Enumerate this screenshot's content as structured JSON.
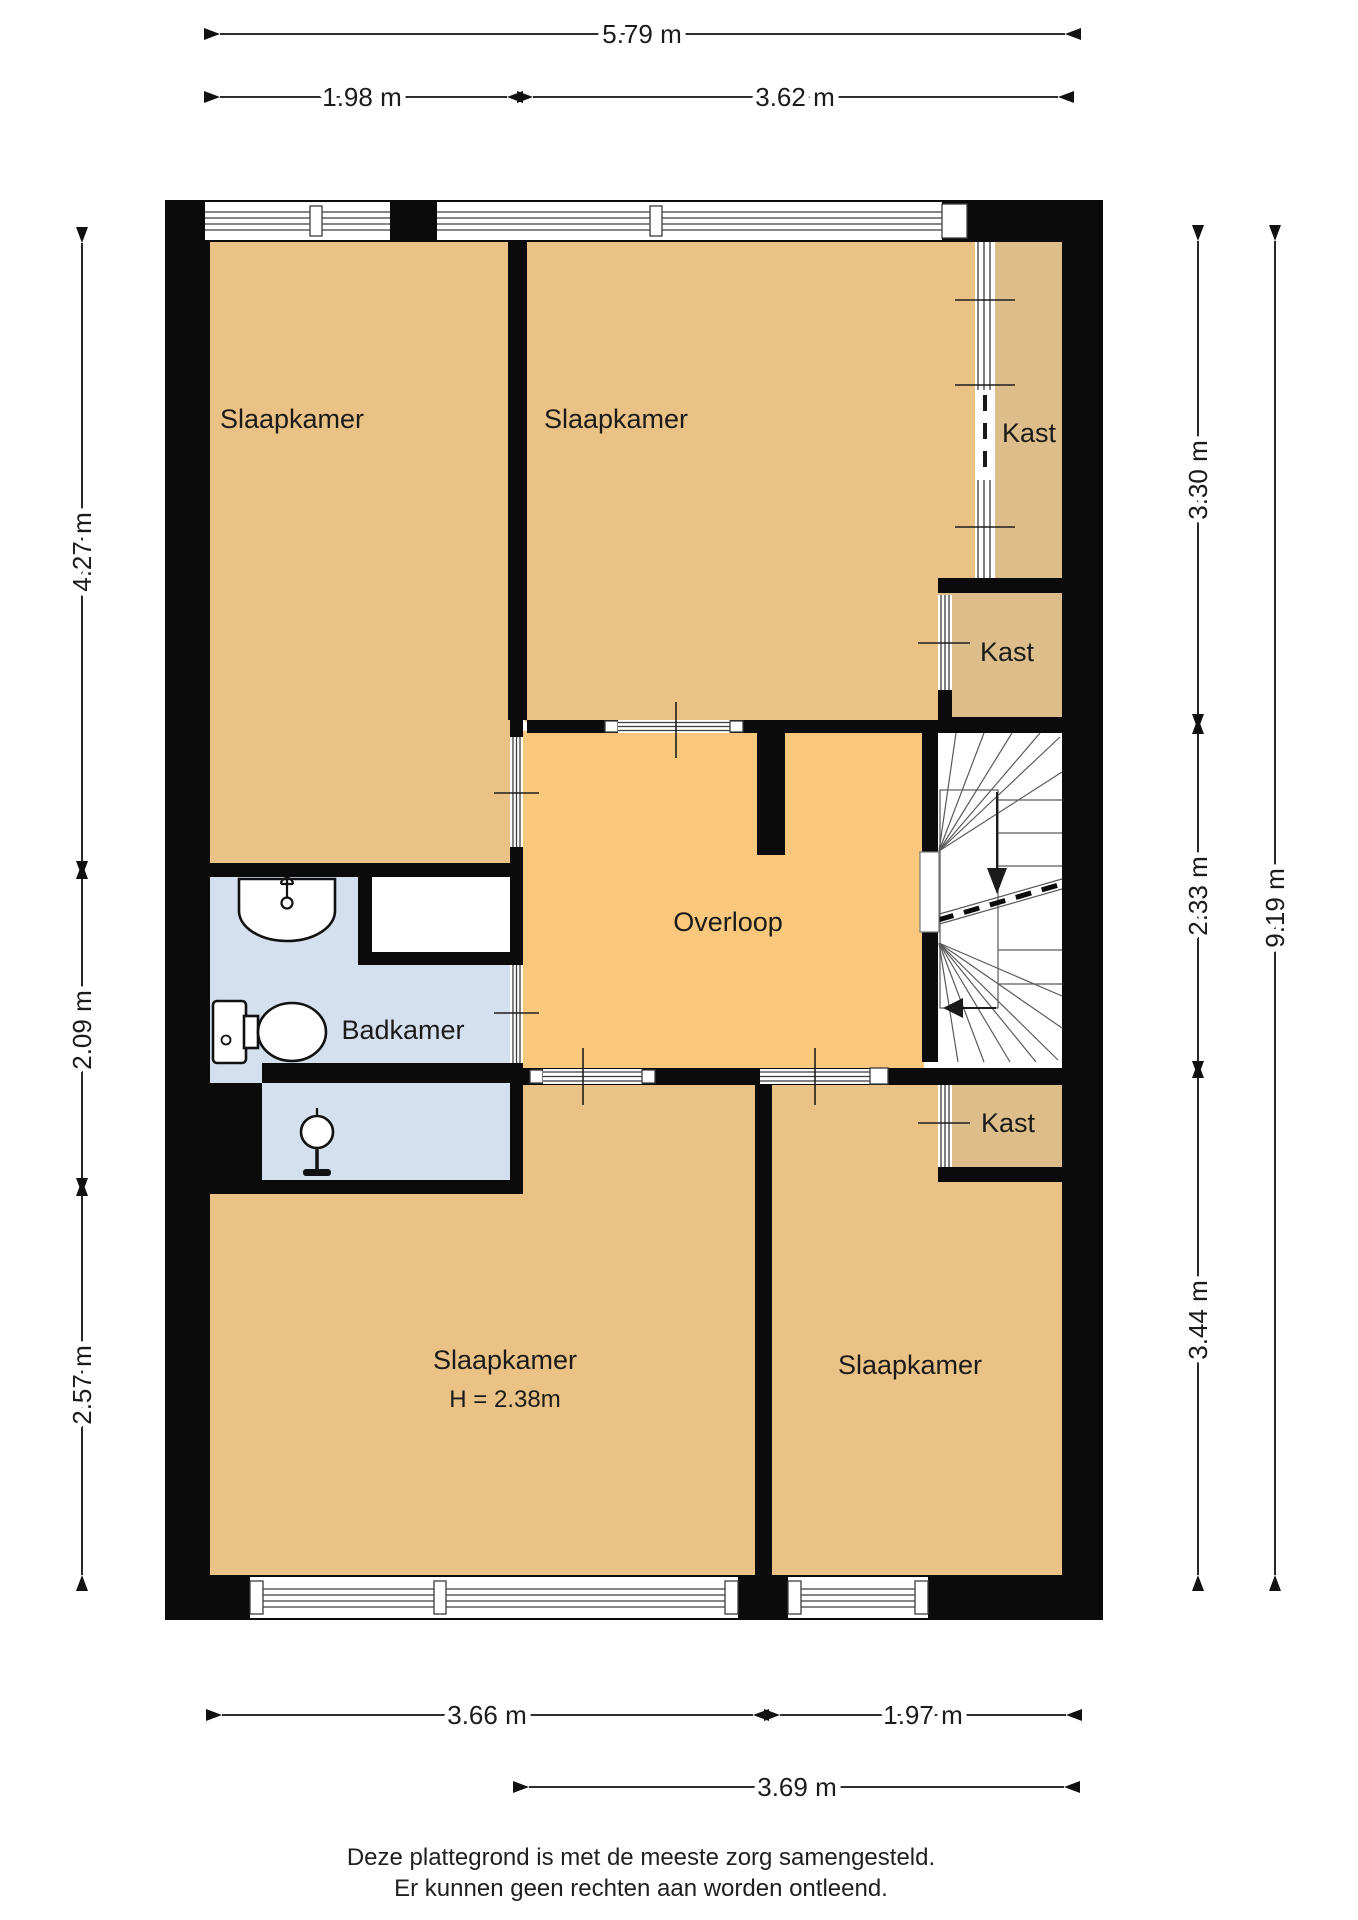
{
  "plan": {
    "rooms": [
      {
        "id": "slaapkamer-top-left",
        "label": "Slaapkamer"
      },
      {
        "id": "slaapkamer-top-middle",
        "label": "Slaapkamer"
      },
      {
        "id": "kast-top",
        "label": "Kast"
      },
      {
        "id": "kast-middle",
        "label": "Kast"
      },
      {
        "id": "overloop",
        "label": "Overloop"
      },
      {
        "id": "badkamer",
        "label": "Badkamer"
      },
      {
        "id": "slaapkamer-bottom-left",
        "label": "Slaapkamer",
        "height_note": "H = 2.38m"
      },
      {
        "id": "slaapkamer-bottom-right",
        "label": "Slaapkamer"
      },
      {
        "id": "kast-bottom",
        "label": "Kast"
      }
    ],
    "dimensions": {
      "top": [
        {
          "label": "5.79 m"
        },
        {
          "label": "1.98 m"
        },
        {
          "label": "3.62 m"
        }
      ],
      "left": [
        {
          "label": "4.27 m"
        },
        {
          "label": "2.09 m"
        },
        {
          "label": "2.57 m"
        }
      ],
      "right": [
        {
          "label": "3.30 m"
        },
        {
          "label": "2.33 m"
        },
        {
          "label": "3.44 m"
        },
        {
          "label": "9.19 m"
        }
      ],
      "bottom": [
        {
          "label": "3.66 m"
        },
        {
          "label": "1.97 m"
        },
        {
          "label": "3.69 m"
        }
      ]
    },
    "colors": {
      "room_fill": "#EBC286",
      "overloop_fill": "#FAC87D",
      "kast_fill": "#DDBE8B",
      "badkamer_fill": "#D4E0ED",
      "wall": "#0B0B0B"
    },
    "footer": {
      "line1": "Deze plattegrond is met de meeste zorg samengesteld.",
      "line2": "Er kunnen geen rechten aan worden ontleend."
    }
  }
}
